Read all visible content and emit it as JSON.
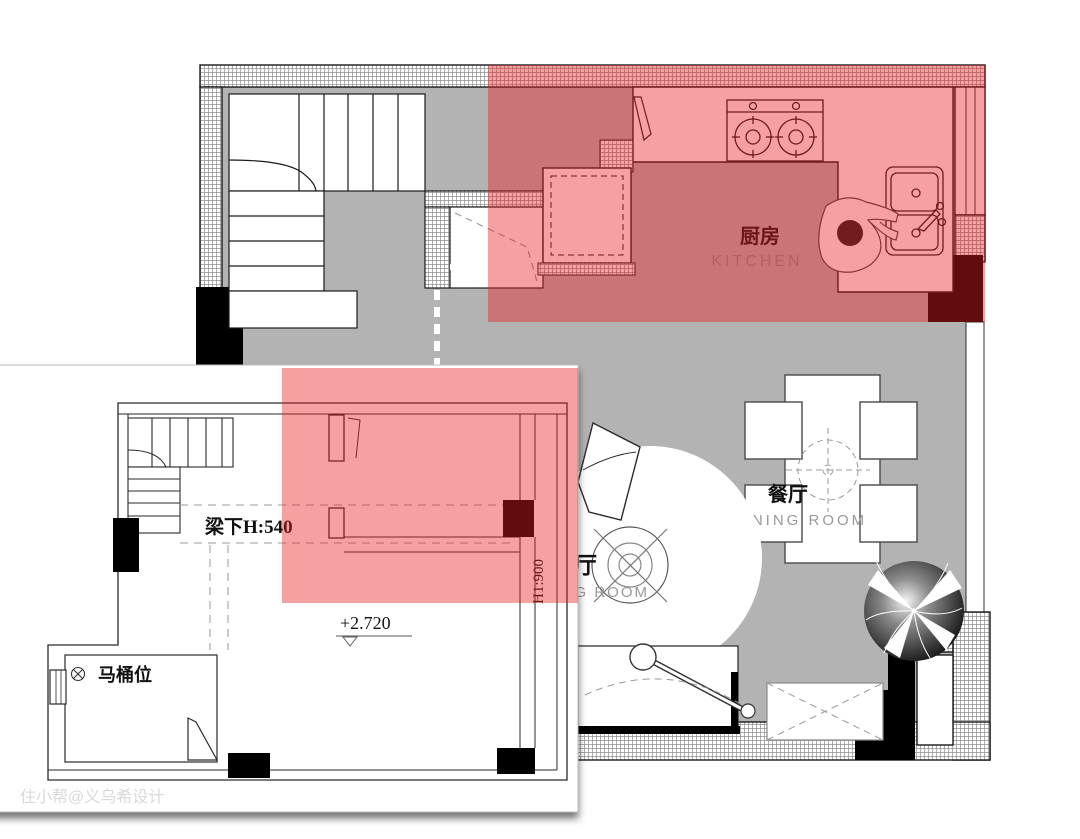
{
  "watermark": "住小帮@义乌希设计",
  "main_plan": {
    "kitchen_zh": "厨房",
    "kitchen_en": "KITCHEN",
    "dining_zh": "餐厅",
    "dining_en": "DINING ROOM",
    "living_zh": "客厅",
    "living_en": "LIVING ROOM"
  },
  "annotations": {
    "beam_height": "梁下H:540",
    "floor_level": "+2.720",
    "toilet_position": "马桶位",
    "wall_height": "H1:900"
  },
  "colors": {
    "highlight_red": "rgba(230,32,32,0.42)",
    "floor_gray": "#b3b3b3",
    "column_black": "#000000",
    "label_gray": "#8f8f8f",
    "line_black": "#1a1a1a"
  }
}
